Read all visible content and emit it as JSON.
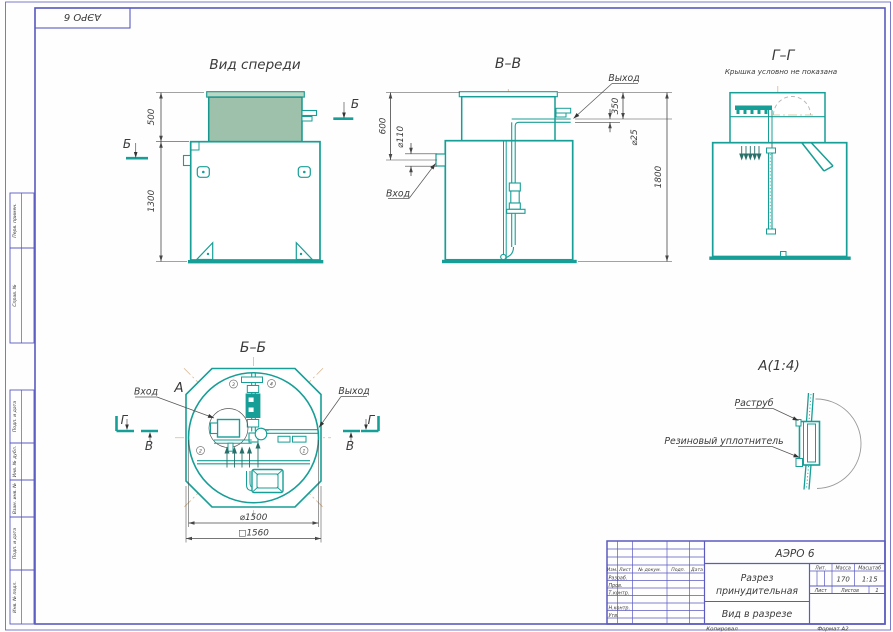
{
  "colors": {
    "drawing_teal": "#179e96",
    "lid_green": "#9dc1ab",
    "frame_blue": "#5a5ac0",
    "construction_tan": "#d9b68f",
    "dim_gray": "#474747",
    "text": "#3b3b3b"
  },
  "frame": {
    "stamp": "АЭРО 6",
    "columns": [
      "Перв. примен.",
      "Справ. №",
      "Подп. и дата",
      "Инв. № дубл.",
      "Взам. инв. №",
      "Подп. и дата",
      "Инв. № подл."
    ],
    "footer_copy": "Копировал",
    "footer_format": "Формат   А2"
  },
  "views": {
    "front": {
      "title": "Вид спереди",
      "dim_lid": "500",
      "dim_body": "1300",
      "marker": "Б"
    },
    "section_vv": {
      "title": "В–В",
      "label_out": "Выход",
      "label_in": "Вход",
      "dim_top": "600",
      "dim_inlet": "⌀110",
      "dim_out_h": "350",
      "dim_pipe": "⌀25",
      "dim_total": "1800"
    },
    "section_gg": {
      "title": "Г–Г",
      "note": "Крышка условно не показана"
    },
    "section_bb": {
      "title": "Б–Б",
      "label_in": "Вход",
      "label_out": "Выход",
      "detail_mark": "А",
      "marker_g": "Г",
      "marker_v": "В",
      "dim_circle": "⌀1500",
      "dim_square": "□1560",
      "callouts": [
        "1",
        "2",
        "3",
        "4"
      ]
    },
    "detail_a": {
      "title": "А(1:4)",
      "label_socket": "Раструб",
      "label_seal": "Резиновый уплотнитель"
    }
  },
  "title_block": {
    "code": "АЭРО 6",
    "name_line1": "Разрез",
    "name_line2": "принудительная",
    "view_name": "Вид в разрезе",
    "mass_value": "170",
    "scale_value": "1:15",
    "sheets_value": "1",
    "col_izm": "Изм.",
    "col_list": "Лист",
    "col_doc": "№ докум.",
    "col_sign": "Подп.",
    "col_date": "Дата",
    "row_dev": "Разраб.",
    "row_check": "Пров.",
    "row_tcontrol": "Т.контр.",
    "row_ncontrol": "Н.контр.",
    "row_approve": "Утв.",
    "lbl_lit": "Лит.",
    "lbl_mass": "Масса",
    "lbl_scale": "Масштаб",
    "lbl_sheet": "Лист",
    "lbl_sheets": "Листов"
  }
}
